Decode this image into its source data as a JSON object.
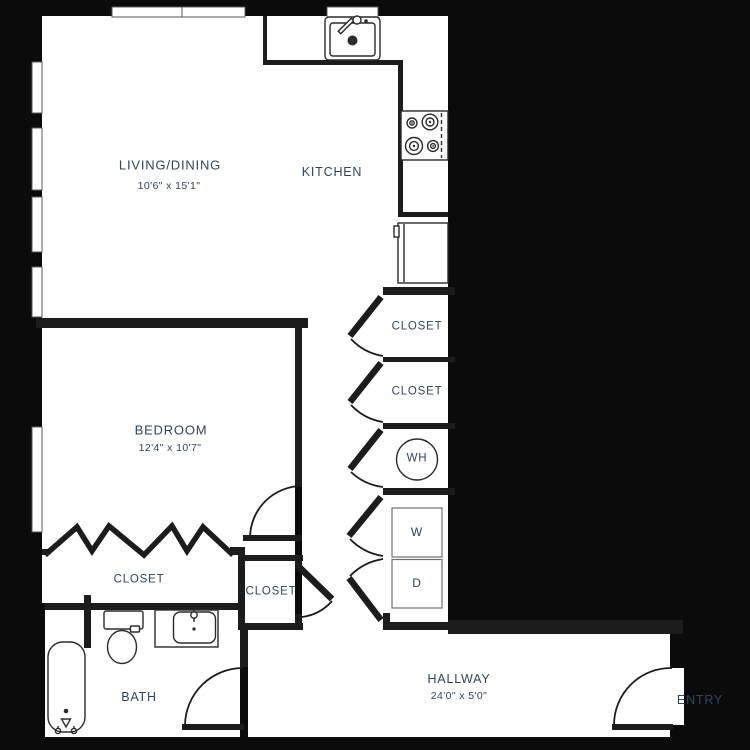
{
  "colors": {
    "background": "#0b0b0b",
    "wall": "#1c1c1c",
    "label_text": "#32455b",
    "fixture_stroke": "#2b2b2b",
    "appliance_stroke": "#707070",
    "window_stroke": "#5a5a5a"
  },
  "rooms": {
    "living_dining": {
      "label": "LIVING/DINING",
      "dimensions": "10'6\" x 15'1\""
    },
    "kitchen": {
      "label": "KITCHEN"
    },
    "bedroom": {
      "label": "BEDROOM",
      "dimensions": "12'4\" x 10'7\""
    },
    "hallway": {
      "label": "HALLWAY",
      "dimensions": "24'0\" x 5'0\""
    },
    "bath": {
      "label": "BATH"
    },
    "entry": {
      "label": "ENTRY"
    },
    "closet_top_right": {
      "label": "CLOSET"
    },
    "closet_mid_right": {
      "label": "CLOSET"
    },
    "closet_bedroom": {
      "label": "CLOSET"
    },
    "closet_hall": {
      "label": "CLOSET"
    },
    "water_heater": {
      "label": "WH"
    },
    "washer": {
      "label": "W"
    },
    "dryer": {
      "label": "D"
    }
  }
}
